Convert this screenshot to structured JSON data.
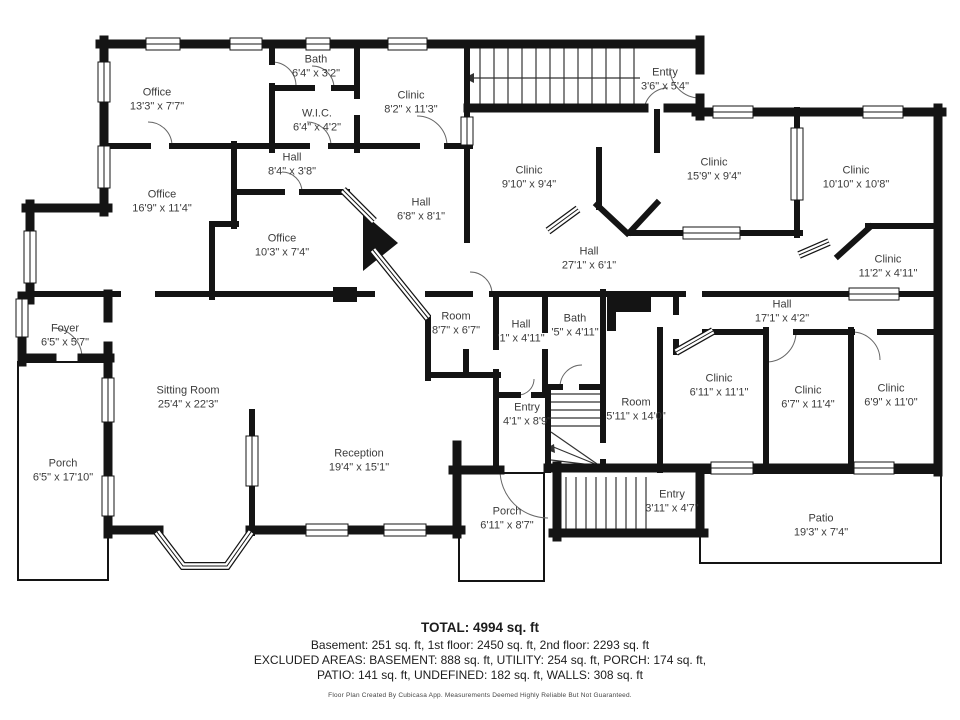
{
  "page": {
    "type": "floor-plan"
  },
  "rooms": [
    {
      "name": "Office",
      "dims": "13'3\" x 7'7\""
    },
    {
      "name": "Bath",
      "dims": "6'4\" x 3'2\""
    },
    {
      "name": "W.I.C.",
      "dims": "6'4\" x 4'2\""
    },
    {
      "name": "Clinic",
      "dims": "8'2\" x 11'3\""
    },
    {
      "name": "Entry",
      "dims": "3'6\" x 5'4\""
    },
    {
      "name": "Hall",
      "dims": "8'4\" x 3'8\""
    },
    {
      "name": "Office",
      "dims": "16'9\" x 11'4\""
    },
    {
      "name": "Clinic",
      "dims": "9'10\" x 9'4\""
    },
    {
      "name": "Clinic",
      "dims": "15'9\" x 9'4\""
    },
    {
      "name": "Clinic",
      "dims": "10'10\" x 10'8\""
    },
    {
      "name": "Office",
      "dims": "10'3\" x 7'4\""
    },
    {
      "name": "Hall",
      "dims": "6'8\" x 8'1\""
    },
    {
      "name": "Hall",
      "dims": "27'1\" x 6'1\""
    },
    {
      "name": "Clinic",
      "dims": "11'2\" x 4'11\""
    },
    {
      "name": "Foyer",
      "dims": "6'5\" x 5'7\""
    },
    {
      "name": "Hall",
      "dims": "17'1\" x 4'2\""
    },
    {
      "name": "Room",
      "dims": "8'7\" x 6'7\""
    },
    {
      "name": "Hall",
      "dims": "'1\" x 4'11\""
    },
    {
      "name": "Bath",
      "dims": "'5\" x 4'11\""
    },
    {
      "name": "Sitting Room",
      "dims": "25'4\" x 22'3\""
    },
    {
      "name": "Room",
      "dims": "5'11\" x 14'0\""
    },
    {
      "name": "Clinic",
      "dims": "6'11\" x 11'1\""
    },
    {
      "name": "Clinic",
      "dims": "6'7\" x 11'4\""
    },
    {
      "name": "Clinic",
      "dims": "6'9\" x 11'0\""
    },
    {
      "name": "Entry",
      "dims": "4'1\" x 8'9\""
    },
    {
      "name": "Porch",
      "dims": "6'5\" x 17'10\""
    },
    {
      "name": "Reception",
      "dims": "19'4\" x 15'1\""
    },
    {
      "name": "Porch",
      "dims": "6'11\" x 8'7\""
    },
    {
      "name": "Entry",
      "dims": "3'11\" x 4'7\""
    },
    {
      "name": "Patio",
      "dims": "19'3\" x 7'4\""
    }
  ],
  "summary": {
    "total": "TOTAL: 4994 sq. ft",
    "floors": "Basement: 251 sq. ft, 1st floor: 2450 sq. ft, 2nd floor: 2293 sq. ft",
    "excluded_1": "EXCLUDED AREAS: BASEMENT: 888 sq. ft, UTILITY: 254 sq. ft, PORCH: 174 sq. ft,",
    "excluded_2": "PATIO: 141 sq. ft, UNDEFINED: 182 sq. ft, WALLS: 308 sq. ft"
  },
  "footer": {
    "disclaimer": "Floor Plan Created By Cubicasa App. Measurements Deemed Highly Reliable But Not Guaranteed."
  },
  "colors": {
    "wall": "#141414",
    "label": "#3b3b3b",
    "background": "#ffffff"
  }
}
